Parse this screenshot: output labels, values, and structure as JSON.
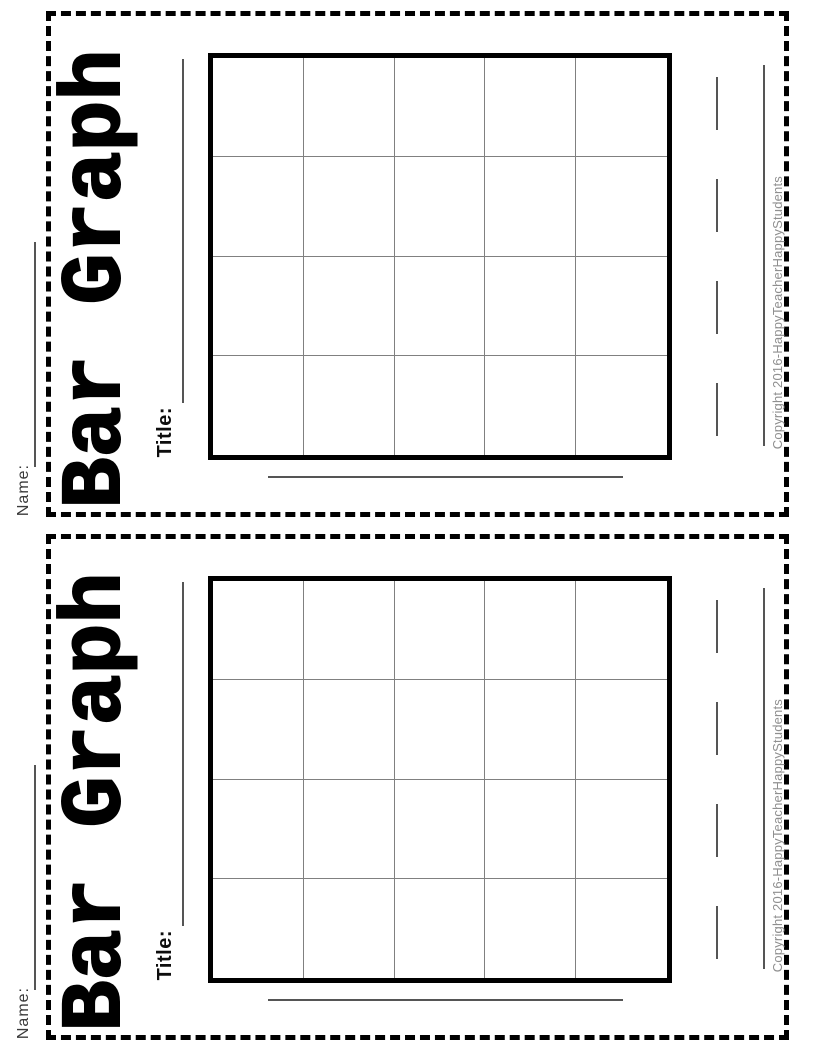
{
  "sheet": {
    "title": "Bar Graph",
    "name_label": "Name:",
    "graph_title_label": "Title:",
    "copyright": "Copyright 2016-HappyTeacherHappyStudents",
    "grid": {
      "rows": 4,
      "columns": 5
    },
    "colors": {
      "ink": "#000000",
      "blank_line": "#555555",
      "grid_inner_line": "#808080",
      "copyright_text": "#8f8f8f"
    }
  }
}
